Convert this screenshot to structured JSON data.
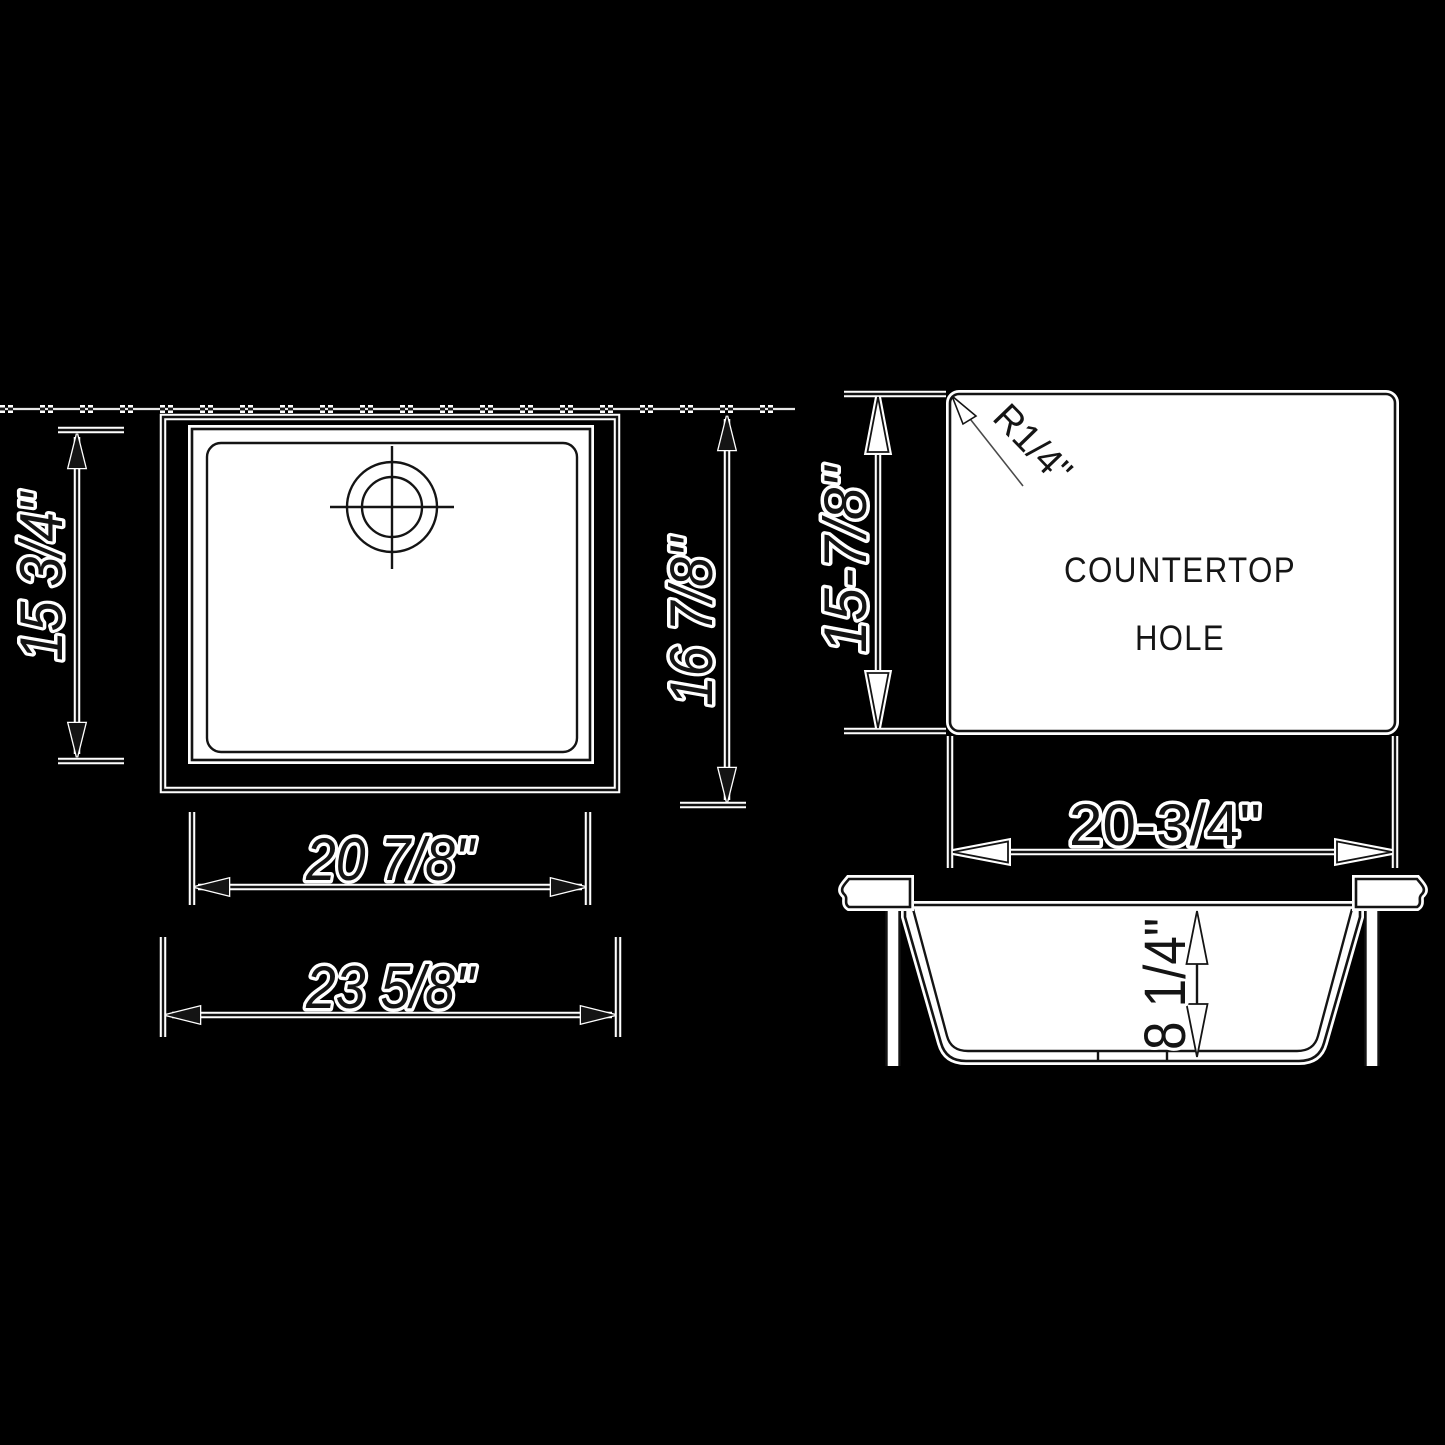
{
  "colors": {
    "background": "#000000",
    "ink": "#141414",
    "halo": "#ffffff",
    "fill": "#ffffff"
  },
  "top_view": {
    "dim_bowl_height": "15 3/4\"",
    "dim_overall_height": "16 7/8\"",
    "dim_rim_width": "20 7/8\"",
    "dim_overall_width": "23 5/8\""
  },
  "hole_view": {
    "label_line1": "COUNTERTOP",
    "label_line2": "HOLE",
    "corner_radius": "R1/4\"",
    "dim_height": "15-7/8\"",
    "dim_width": "20-3/4\""
  },
  "section_view": {
    "dim_depth": "8 1/4\""
  }
}
